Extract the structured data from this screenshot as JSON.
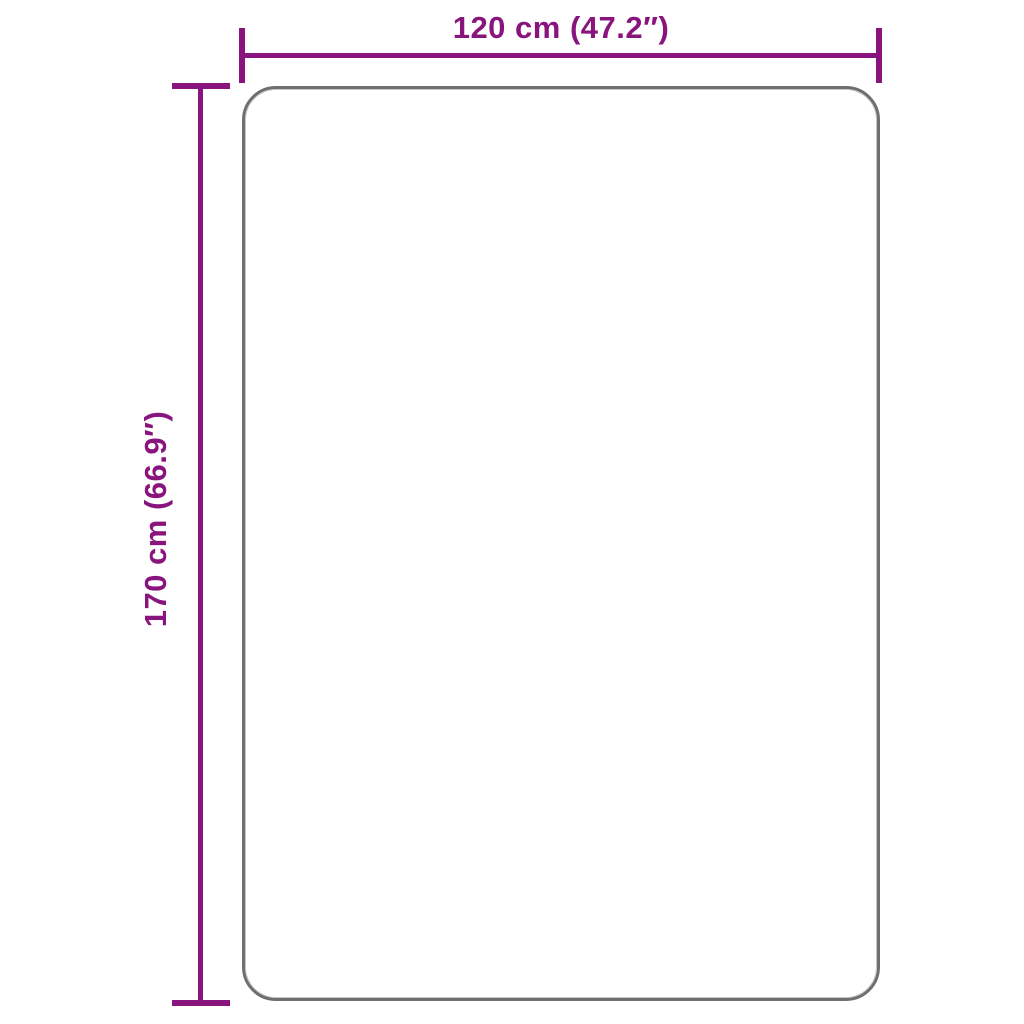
{
  "figure": {
    "type": "product-dimension-diagram",
    "background_color": "#ffffff",
    "accent_color": "#8a147e",
    "outline_color": "#6f6f6f",
    "product_shape": "rounded-rectangle rug outline, empty white fill",
    "width_dimension": {
      "label": "120 cm (47.2″)",
      "value_cm": 120,
      "value_in": 47.2,
      "orientation": "horizontal-top"
    },
    "height_dimension": {
      "label": "170 cm (66.9″)",
      "value_cm": 170,
      "value_in": 66.9,
      "orientation": "vertical-left-rotated"
    }
  }
}
